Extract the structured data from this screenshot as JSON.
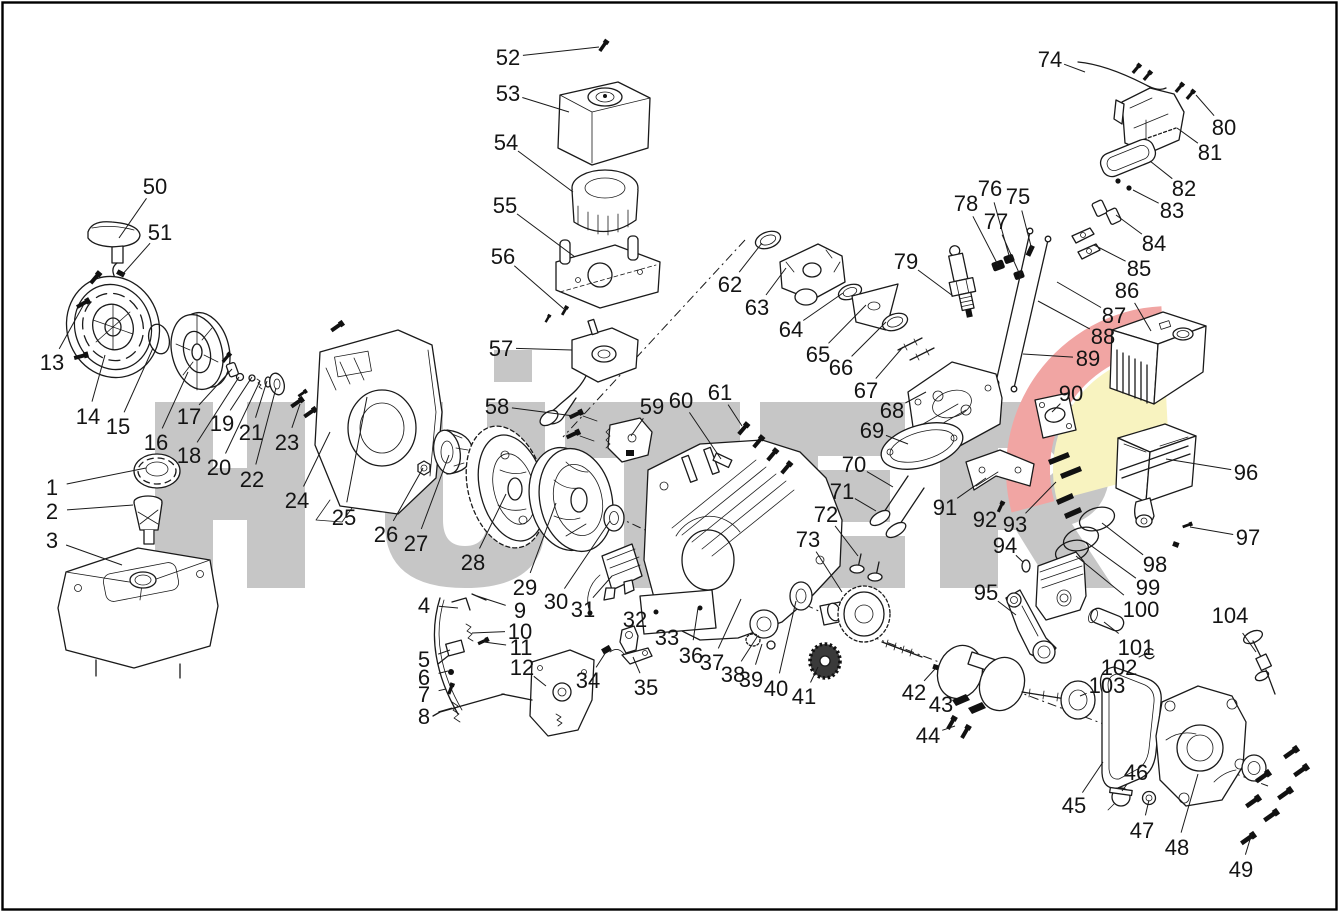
{
  "page": {
    "background": "#ffffff",
    "border_color": "#000000"
  },
  "watermark": {
    "text": "HÜTER",
    "color": "#c6c6c6",
    "accent_red": "#f1a5a3",
    "accent_yellow": "#f8f3c0"
  },
  "diagram": {
    "kind": "engine-exploded-parts-diagram",
    "artifact_color": "#e0a43c",
    "labels": [
      {
        "n": "1",
        "x": 52,
        "y": 487,
        "tx": 146,
        "ty": 468
      },
      {
        "n": "2",
        "x": 52,
        "y": 511,
        "tx": 133,
        "ty": 505
      },
      {
        "n": "3",
        "x": 52,
        "y": 540,
        "tx": 122,
        "ty": 565
      },
      {
        "n": "4",
        "x": 424,
        "y": 605,
        "tx": 458,
        "ty": 608
      },
      {
        "n": "5",
        "x": 424,
        "y": 659,
        "tx": 450,
        "ty": 650
      },
      {
        "n": "6",
        "x": 424,
        "y": 677,
        "tx": 448,
        "ty": 671
      },
      {
        "n": "7",
        "x": 424,
        "y": 694,
        "tx": 446,
        "ty": 689
      },
      {
        "n": "8",
        "x": 424,
        "y": 716,
        "tx": 452,
        "ty": 708
      },
      {
        "n": "9",
        "x": 520,
        "y": 610,
        "tx": 477,
        "ty": 596
      },
      {
        "n": "10",
        "x": 520,
        "y": 631,
        "tx": 472,
        "ty": 633
      },
      {
        "n": "11",
        "x": 521,
        "y": 647,
        "tx": 484,
        "ty": 642
      },
      {
        "n": "12",
        "x": 522,
        "y": 667,
        "tx": 546,
        "ty": 686
      },
      {
        "n": "13",
        "x": 52,
        "y": 362,
        "tx": 84,
        "ty": 304
      },
      {
        "n": "14",
        "x": 88,
        "y": 416,
        "tx": 105,
        "ty": 355
      },
      {
        "n": "15",
        "x": 118,
        "y": 426,
        "tx": 153,
        "ty": 348
      },
      {
        "n": "16",
        "x": 156,
        "y": 442,
        "tx": 188,
        "ty": 372
      },
      {
        "n": "17",
        "x": 189,
        "y": 416,
        "tx": 232,
        "ty": 369
      },
      {
        "n": "18",
        "x": 189,
        "y": 455,
        "tx": 239,
        "ty": 377
      },
      {
        "n": "19",
        "x": 222,
        "y": 423,
        "tx": 252,
        "ty": 377
      },
      {
        "n": "20",
        "x": 219,
        "y": 467,
        "tx": 260,
        "ty": 381
      },
      {
        "n": "21",
        "x": 251,
        "y": 432,
        "tx": 267,
        "ty": 381
      },
      {
        "n": "22",
        "x": 252,
        "y": 479,
        "tx": 276,
        "ty": 388
      },
      {
        "n": "23",
        "x": 287,
        "y": 442,
        "tx": 300,
        "ty": 404
      },
      {
        "n": "24",
        "x": 297,
        "y": 500,
        "tx": 330,
        "ty": 432
      },
      {
        "n": "25",
        "x": 344,
        "y": 517,
        "tx": 367,
        "ty": 397
      },
      {
        "n": "26",
        "x": 386,
        "y": 534,
        "tx": 423,
        "ty": 468
      },
      {
        "n": "27",
        "x": 416,
        "y": 543,
        "tx": 449,
        "ty": 455
      },
      {
        "n": "28",
        "x": 473,
        "y": 562,
        "tx": 506,
        "ty": 494
      },
      {
        "n": "29",
        "x": 525,
        "y": 587,
        "tx": 556,
        "ty": 503
      },
      {
        "n": "30",
        "x": 556,
        "y": 601,
        "tx": 610,
        "ty": 521
      },
      {
        "n": "31",
        "x": 583,
        "y": 609,
        "tx": 612,
        "ty": 576
      },
      {
        "n": "32",
        "x": 635,
        "y": 619,
        "tx": 628,
        "ty": 632
      },
      {
        "n": "33",
        "x": 667,
        "y": 637,
        "tx": 657,
        "ty": 624
      },
      {
        "n": "34",
        "x": 588,
        "y": 680,
        "tx": 606,
        "ty": 652
      },
      {
        "n": "35",
        "x": 646,
        "y": 687,
        "tx": 633,
        "ty": 657
      },
      {
        "n": "36",
        "x": 691,
        "y": 655,
        "tx": 698,
        "ty": 608
      },
      {
        "n": "37",
        "x": 712,
        "y": 662,
        "tx": 741,
        "ty": 599
      },
      {
        "n": "38",
        "x": 733,
        "y": 674,
        "tx": 757,
        "ty": 637
      },
      {
        "n": "39",
        "x": 751,
        "y": 679,
        "tx": 762,
        "ty": 644
      },
      {
        "n": "40",
        "x": 776,
        "y": 688,
        "tx": 796,
        "ty": 601
      },
      {
        "n": "41",
        "x": 804,
        "y": 696,
        "tx": 818,
        "ty": 667
      },
      {
        "n": "42",
        "x": 914,
        "y": 692,
        "tx": 935,
        "ty": 669
      },
      {
        "n": "43",
        "x": 941,
        "y": 704,
        "tx": 960,
        "ty": 701
      },
      {
        "n": "44",
        "x": 928,
        "y": 735,
        "tx": 955,
        "ty": 726
      },
      {
        "n": "45",
        "x": 1074,
        "y": 805,
        "tx": 1103,
        "ty": 762
      },
      {
        "n": "46",
        "x": 1136,
        "y": 772,
        "tx": 1122,
        "ty": 791
      },
      {
        "n": "47",
        "x": 1142,
        "y": 830,
        "tx": 1149,
        "ty": 800
      },
      {
        "n": "48",
        "x": 1177,
        "y": 847,
        "tx": 1198,
        "ty": 774
      },
      {
        "n": "49",
        "x": 1241,
        "y": 869,
        "tx": 1252,
        "ty": 833
      },
      {
        "n": "50",
        "x": 155,
        "y": 186,
        "tx": 119,
        "ty": 238
      },
      {
        "n": "51",
        "x": 160,
        "y": 232,
        "tx": 121,
        "ty": 276
      },
      {
        "n": "52",
        "x": 508,
        "y": 57,
        "tx": 599,
        "ty": 47
      },
      {
        "n": "53",
        "x": 508,
        "y": 93,
        "tx": 569,
        "ty": 112
      },
      {
        "n": "54",
        "x": 506,
        "y": 142,
        "tx": 573,
        "ty": 192
      },
      {
        "n": "55",
        "x": 505,
        "y": 205,
        "tx": 575,
        "ty": 257
      },
      {
        "n": "56",
        "x": 503,
        "y": 256,
        "tx": 564,
        "ty": 309
      },
      {
        "n": "57",
        "x": 501,
        "y": 348,
        "tx": 572,
        "ty": 350
      },
      {
        "n": "58",
        "x": 497,
        "y": 406,
        "tx": 574,
        "ty": 416
      },
      {
        "n": "59",
        "x": 652,
        "y": 406,
        "tx": 631,
        "ty": 436
      },
      {
        "n": "60",
        "x": 681,
        "y": 400,
        "tx": 721,
        "ty": 459
      },
      {
        "n": "61",
        "x": 720,
        "y": 392,
        "tx": 742,
        "ty": 426
      },
      {
        "n": "62",
        "x": 730,
        "y": 284,
        "tx": 762,
        "ty": 243
      },
      {
        "n": "63",
        "x": 757,
        "y": 307,
        "tx": 786,
        "ty": 268
      },
      {
        "n": "64",
        "x": 791,
        "y": 329,
        "tx": 843,
        "ty": 293
      },
      {
        "n": "65",
        "x": 818,
        "y": 354,
        "tx": 866,
        "ty": 305
      },
      {
        "n": "66",
        "x": 841,
        "y": 367,
        "tx": 886,
        "ty": 322
      },
      {
        "n": "67",
        "x": 866,
        "y": 390,
        "tx": 903,
        "ty": 347
      },
      {
        "n": "68",
        "x": 892,
        "y": 410,
        "tx": 926,
        "ty": 392
      },
      {
        "n": "69",
        "x": 872,
        "y": 430,
        "tx": 908,
        "ty": 444
      },
      {
        "n": "70",
        "x": 854,
        "y": 464,
        "tx": 893,
        "ty": 487
      },
      {
        "n": "71",
        "x": 842,
        "y": 491,
        "tx": 876,
        "ty": 511
      },
      {
        "n": "72",
        "x": 826,
        "y": 514,
        "tx": 858,
        "ty": 556
      },
      {
        "n": "73",
        "x": 808,
        "y": 539,
        "tx": 842,
        "ty": 592
      },
      {
        "n": "74",
        "x": 1050,
        "y": 59,
        "tx": 1085,
        "ty": 72
      },
      {
        "n": "75",
        "x": 1018,
        "y": 196,
        "tx": 1032,
        "ty": 250
      },
      {
        "n": "76",
        "x": 990,
        "y": 188,
        "tx": 1010,
        "ty": 259
      },
      {
        "n": "77",
        "x": 996,
        "y": 221,
        "tx": 1020,
        "ty": 275
      },
      {
        "n": "78",
        "x": 966,
        "y": 203,
        "tx": 998,
        "ty": 265
      },
      {
        "n": "79",
        "x": 906,
        "y": 261,
        "tx": 953,
        "ty": 296
      },
      {
        "n": "80",
        "x": 1224,
        "y": 127,
        "tx": 1196,
        "ty": 95
      },
      {
        "n": "81",
        "x": 1210,
        "y": 152,
        "tx": 1177,
        "ty": 128
      },
      {
        "n": "82",
        "x": 1184,
        "y": 188,
        "tx": 1150,
        "ty": 161
      },
      {
        "n": "83",
        "x": 1172,
        "y": 210,
        "tx": 1133,
        "ty": 190
      },
      {
        "n": "84",
        "x": 1154,
        "y": 243,
        "tx": 1116,
        "ty": 215
      },
      {
        "n": "85",
        "x": 1139,
        "y": 268,
        "tx": 1094,
        "ty": 245
      },
      {
        "n": "86",
        "x": 1127,
        "y": 290,
        "tx": 1151,
        "ty": 331
      },
      {
        "n": "87",
        "x": 1114,
        "y": 315,
        "tx": 1057,
        "ty": 282
      },
      {
        "n": "88",
        "x": 1103,
        "y": 336,
        "tx": 1038,
        "ty": 301
      },
      {
        "n": "89",
        "x": 1088,
        "y": 358,
        "tx": 1023,
        "ty": 354
      },
      {
        "n": "90",
        "x": 1071,
        "y": 393,
        "tx": 1052,
        "ty": 412
      },
      {
        "n": "91",
        "x": 945,
        "y": 507,
        "tx": 986,
        "ty": 478
      },
      {
        "n": "92",
        "x": 985,
        "y": 519,
        "tx": 1000,
        "ty": 508
      },
      {
        "n": "93",
        "x": 1015,
        "y": 524,
        "tx": 1056,
        "ty": 482
      },
      {
        "n": "94",
        "x": 1005,
        "y": 545,
        "tx": 1023,
        "ty": 562
      },
      {
        "n": "95",
        "x": 986,
        "y": 592,
        "tx": 1016,
        "ty": 615
      },
      {
        "n": "96",
        "x": 1246,
        "y": 472,
        "tx": 1166,
        "ty": 459
      },
      {
        "n": "97",
        "x": 1248,
        "y": 537,
        "tx": 1190,
        "ty": 527
      },
      {
        "n": "98",
        "x": 1155,
        "y": 564,
        "tx": 1102,
        "ty": 523
      },
      {
        "n": "99",
        "x": 1148,
        "y": 587,
        "tx": 1086,
        "ty": 542
      },
      {
        "n": "100",
        "x": 1141,
        "y": 609,
        "tx": 1076,
        "ty": 556
      },
      {
        "n": "101",
        "x": 1136,
        "y": 647,
        "tx": 1104,
        "ty": 622
      },
      {
        "n": "102",
        "x": 1119,
        "y": 667,
        "tx": 1147,
        "ty": 653
      },
      {
        "n": "103",
        "x": 1107,
        "y": 685,
        "tx": 1080,
        "ty": 696
      },
      {
        "n": "104",
        "x": 1230,
        "y": 615,
        "tx": 1256,
        "ty": 652
      }
    ]
  }
}
